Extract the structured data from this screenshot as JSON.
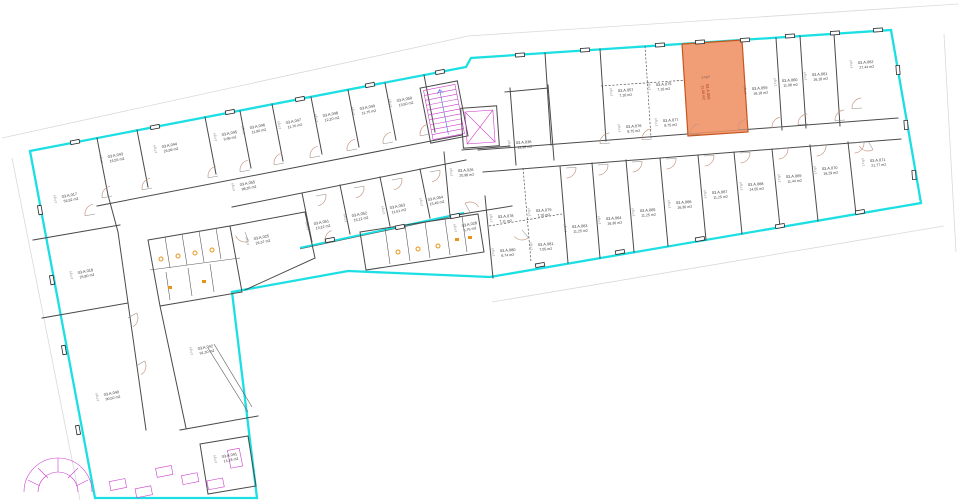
{
  "drawing": {
    "type": "architectural-floor-plan",
    "label_fields": [
      "ID",
      "NR",
      "FL",
      "LH"
    ],
    "highlight_room": {
      "id": "03.A.058",
      "area": "11,08 m2"
    },
    "colors": {
      "boundary": "#1bdfe2",
      "walls": "#4a4a4a",
      "highlight_fill": "#ef8f62",
      "highlight_stroke": "#c7551f",
      "stairs": "#cc3fcc",
      "fixtures": "#e8941a",
      "doors": "#c69884",
      "text": "#3a3a3a"
    },
    "rooms": [
      {
        "id": "03.A.017",
        "area": "56,92 m2"
      },
      {
        "id": "03.A.043",
        "area": "16,55 m2"
      },
      {
        "id": "03.A.044",
        "area": "26,99 m2"
      },
      {
        "id": "03.A.045",
        "area": "9,99 m2"
      },
      {
        "id": "03.A.046",
        "area": "11,90 m2"
      },
      {
        "id": "03.A.047",
        "area": "11,76 m2"
      },
      {
        "id": "03.A.048",
        "area": "12,20 m2"
      },
      {
        "id": "03.A.049",
        "area": "11,75 m2"
      },
      {
        "id": "03.A.050",
        "area": "13,60 m2"
      },
      {
        "id": "03.A.055",
        "area": "98,35 m2"
      },
      {
        "id": "03.A.051",
        "area": "13,22 m2"
      },
      {
        "id": "03.A.052",
        "area": "16,12 m2"
      },
      {
        "id": "03.A.053",
        "area": "11,61 m2"
      },
      {
        "id": "03.A.054",
        "area": "15,49 m2"
      },
      {
        "id": "03.A.018",
        "area": "25,80 m2"
      },
      {
        "id": "03.A.025",
        "area": "26,37 m2"
      },
      {
        "id": "03.A.042",
        "area": "91,30 m2"
      },
      {
        "id": "03.A.040",
        "area": "90,50 m2"
      },
      {
        "id": "03.A.041",
        "area": "14,18 m2"
      },
      {
        "id": "03.A.026",
        "area": "20,98 m2"
      },
      {
        "id": "03.A.036",
        "area": "13,36 m2"
      },
      {
        "id": "03.A.028",
        "area": "6,76 m2"
      },
      {
        "id": "03.A.057",
        "area": "7,16 m2"
      },
      {
        "id": "03.A.075",
        "area": "7,16 m2"
      },
      {
        "id": "03.A.076",
        "area": "8,75 m2"
      },
      {
        "id": "03.A.077",
        "area": "8,75 m2"
      },
      {
        "id": "03.A.059",
        "area": "16,18 m2"
      },
      {
        "id": "03.A.060",
        "area": "11,08 m2"
      },
      {
        "id": "03.A.061",
        "area": "16,18 m2"
      },
      {
        "id": "03.A.062",
        "area": "27,44 m2"
      },
      {
        "id": "03.A.078",
        "area": "7,11 m2"
      },
      {
        "id": "03.A.079",
        "area": "7,16 m2"
      },
      {
        "id": "03.A.080",
        "area": "6,74 m2"
      },
      {
        "id": "03.A.081",
        "area": "7,05 m2"
      },
      {
        "id": "03.A.063",
        "area": "11,25 m2"
      },
      {
        "id": "03.A.064",
        "area": "16,30 m2"
      },
      {
        "id": "03.A.065",
        "area": "11,25 m2"
      },
      {
        "id": "03.A.066",
        "area": "16,30 m2"
      },
      {
        "id": "03.A.067",
        "area": "11,25 m2"
      },
      {
        "id": "03.A.068",
        "area": "14,55 m2"
      },
      {
        "id": "03.A.069",
        "area": "11,44 m2"
      },
      {
        "id": "03.A.070",
        "area": "16,29 m2"
      },
      {
        "id": "03.A.071",
        "area": "21,77 m2"
      },
      {
        "id": "03.A.058",
        "area": "11,08 m2",
        "highlight": true
      }
    ]
  }
}
